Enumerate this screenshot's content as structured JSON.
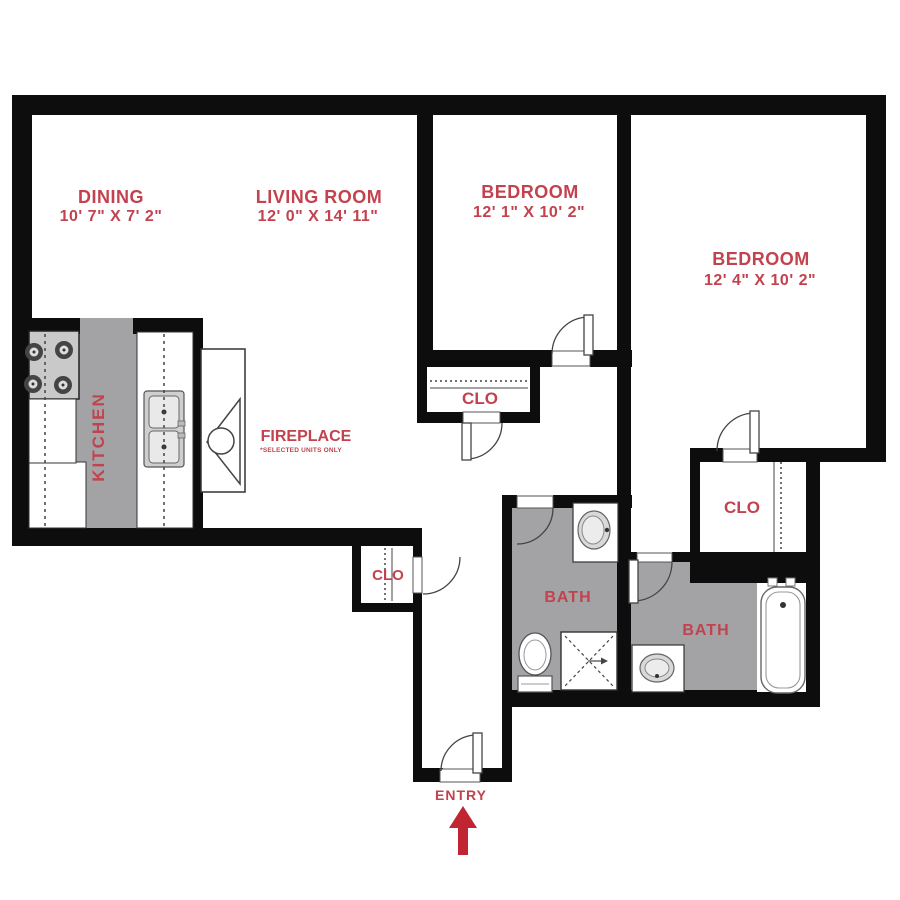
{
  "plan": {
    "title": "Two bedroom two bath apartment floor plan",
    "rooms": {
      "dining": {
        "name": "DINING",
        "dims": "10' 7\" X 7' 2\""
      },
      "living": {
        "name": "LIVING ROOM",
        "dims": "12' 0\" X 14' 11\""
      },
      "bedroom1": {
        "name": "BEDROOM",
        "dims": "12' 1\" X 10' 2\""
      },
      "bedroom2": {
        "name": "BEDROOM",
        "dims": "12' 4\" X 10' 2\""
      },
      "kitchen": {
        "name": "KITCHEN"
      },
      "fireplace": {
        "name": "FIREPLACE",
        "note": "*SELECTED UNITS ONLY"
      },
      "closet1": {
        "name": "CLO"
      },
      "closet_entry": {
        "name": "CLO"
      },
      "closet2": {
        "name": "CLO"
      },
      "bath1": {
        "name": "BATH"
      },
      "bath2": {
        "name": "BATH"
      },
      "entry": {
        "name": "ENTRY"
      }
    },
    "colors": {
      "wall": "#0d0d0d",
      "floor_gray": "#a3a3a5",
      "label_red": "#c2424e",
      "arrow_red": "#c02531",
      "fixture_line": "#555555"
    }
  }
}
